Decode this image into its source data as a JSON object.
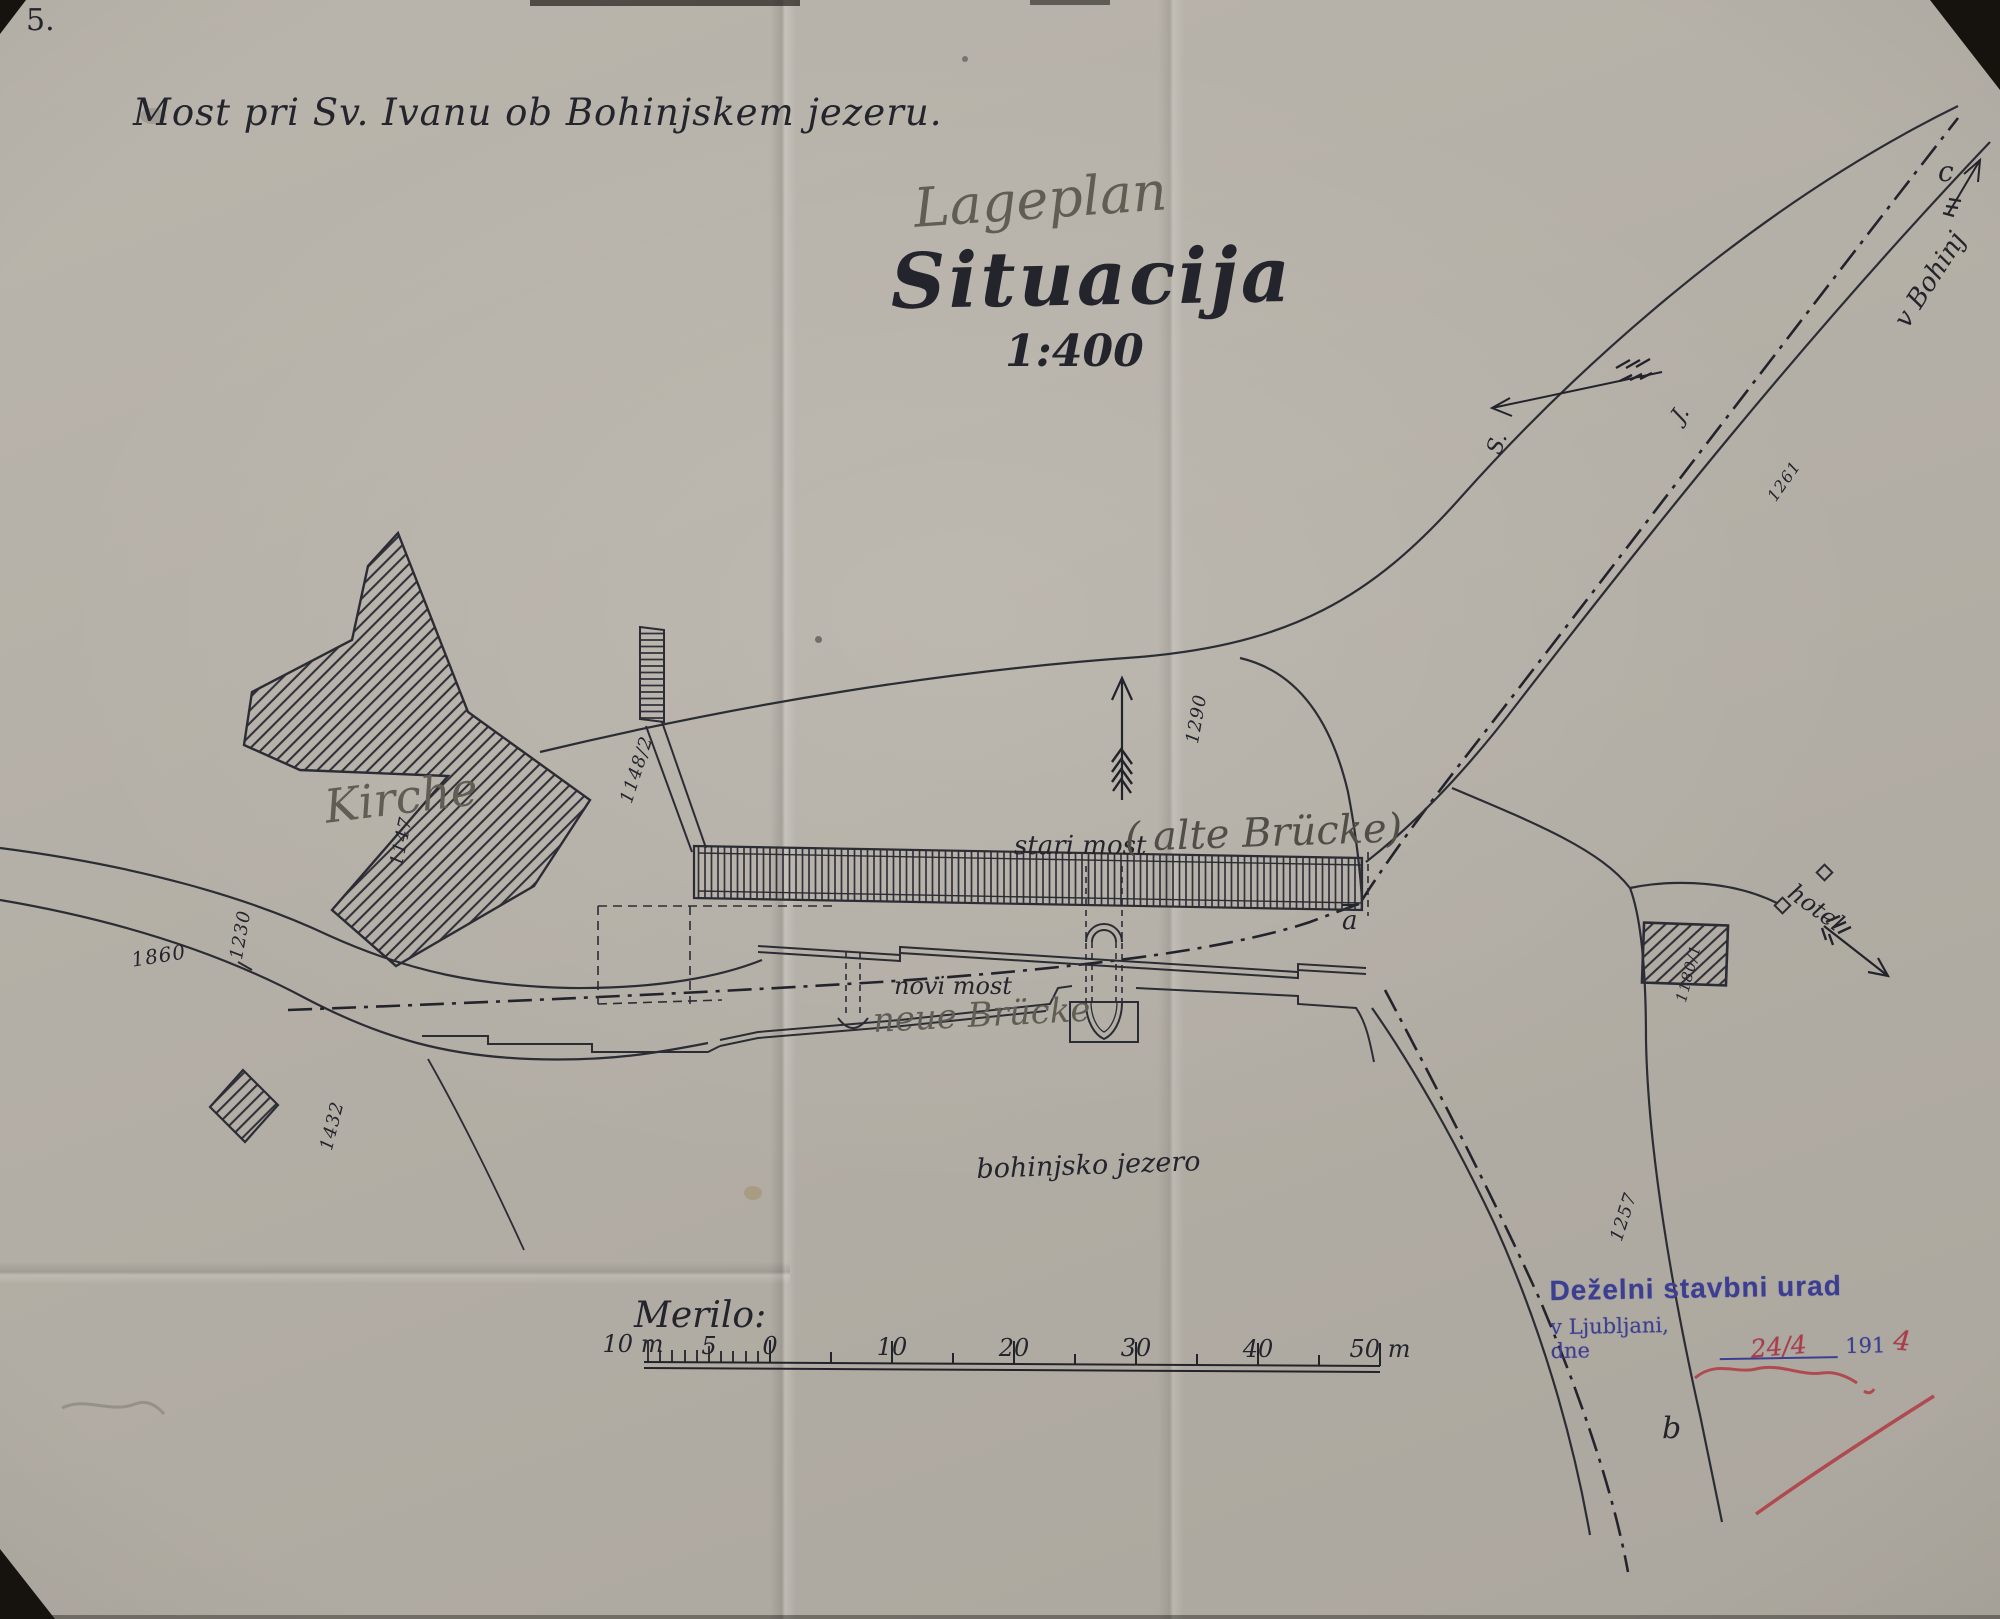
{
  "page_number": "5.",
  "header": {
    "title": "Most pri Sv. Ivanu ob Bohinjskem jezeru."
  },
  "titles": {
    "pencil": "Lageplan",
    "main": "Situacija",
    "scale": "1:400"
  },
  "map_labels": {
    "kirche": "Kirche",
    "stari_most": "stari most",
    "alte_bruecke": "( alte Brücke)",
    "novi_most": "novi most",
    "neue_bruecke": "neue Brücke",
    "lake": "bohinjsko jezero",
    "hotel": "hotel",
    "road_to_bohinj": "v Bohinj",
    "compass_n": "S.",
    "compass_s": "J.",
    "point_a": "a",
    "point_b": "b",
    "point_c": "c"
  },
  "parcel_numbers": {
    "church": "1147",
    "church2": "1148/2",
    "left_upper": "1230",
    "left_road": "1860",
    "left_lower": "1432",
    "center": "1290",
    "bohinj_road": "1261",
    "south_road": "1257",
    "hotel": "1180/1"
  },
  "scale_bar": {
    "label": "Merilo:",
    "ticks": [
      "10 m",
      "5",
      "0",
      "10",
      "20",
      "30",
      "40",
      "50 m"
    ]
  },
  "stamp": {
    "line1": "Deželni stavbni urad",
    "line2": "v Ljubljani, dne",
    "date": "24/4",
    "year": "191",
    "year_digit": "4"
  },
  "colors": {
    "ink": "#24242d",
    "pencil": "#605d55",
    "stamp_blue": "#3c3e92",
    "annotation_red": "#b13a44",
    "paper": "#b6b1a8"
  }
}
